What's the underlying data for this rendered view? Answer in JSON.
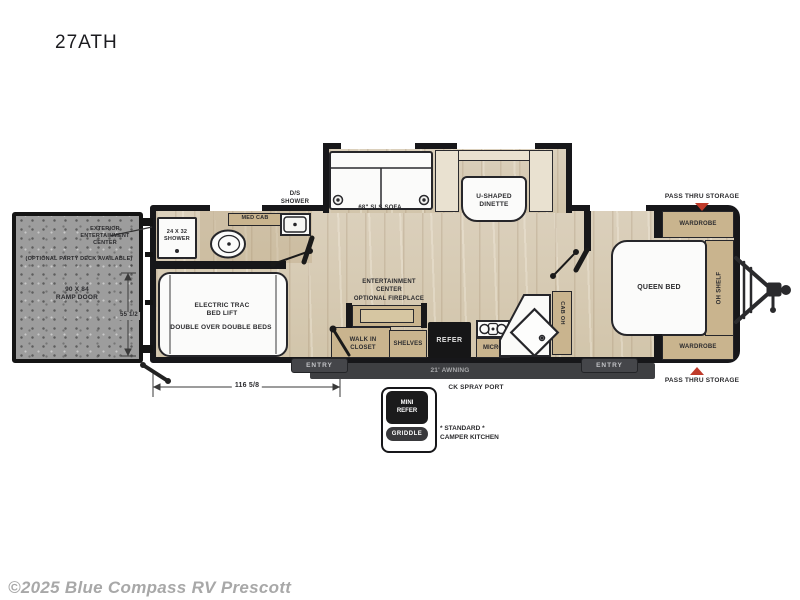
{
  "title": "27ATH",
  "watermark": "©2025 Blue Compass RV Prescott",
  "colors": {
    "wall": "#17171a",
    "cabinet_tan": "#c9b48e",
    "floor_wood": "#d8ccb6",
    "ramp_gray": "#9d9d9d",
    "arrow_red": "#bf3a2a",
    "exterior_bar": "#3e3f42"
  },
  "exterior_labels": {
    "pass_thru_top": "PASS THRU STORAGE",
    "pass_thru_bottom": "PASS THRU STORAGE",
    "awning": "21' AWNING",
    "ck_spray_port": "CK SPRAY PORT",
    "entry_left": "ENTRY",
    "entry_right": "ENTRY",
    "length_dim": "116 5/8",
    "ramp_height_dim": "55 1/2",
    "camper_kitchen_note": "* STANDARD *\nCAMPER KITCHEN",
    "mini_refer": "MINI\nREFER",
    "griddle": "GRIDDLE"
  },
  "garage": {
    "ext_ent_center": "EXTERIOR\nENTERTAINMENT\nCENTER",
    "party_deck": "(OPTIONAL PARTY DECK AVAILABLE)",
    "ramp_door": "90 X 84\nRAMP DOOR",
    "bed_lift": "ELECTRIC TRAC\nBED LIFT",
    "bed_type": "DOUBLE OVER DOUBLE BEDS",
    "shower_small": "24 X 32\nSHOWER",
    "med_cab": "MED CAB",
    "ds_shower": "D/S\nSHOWER"
  },
  "living": {
    "sofa": "68\" SLS SOFA",
    "dinette": "U-SHAPED\nDINETTE",
    "ent_center": "ENTERTAINMENT\nCENTER",
    "fireplace": "OPTIONAL FIREPLACE",
    "walk_in_closet": "WALK IN\nCLOSET",
    "shelves": "SHELVES",
    "refer": "REFER",
    "micro": "MICRO",
    "cab_oh": "CAB OH"
  },
  "bedroom": {
    "queen_bed": "QUEEN BED",
    "wardrobe_top": "WARDROBE",
    "wardrobe_bottom": "WARDROBE",
    "oh_shelf": "OH SHELF"
  }
}
